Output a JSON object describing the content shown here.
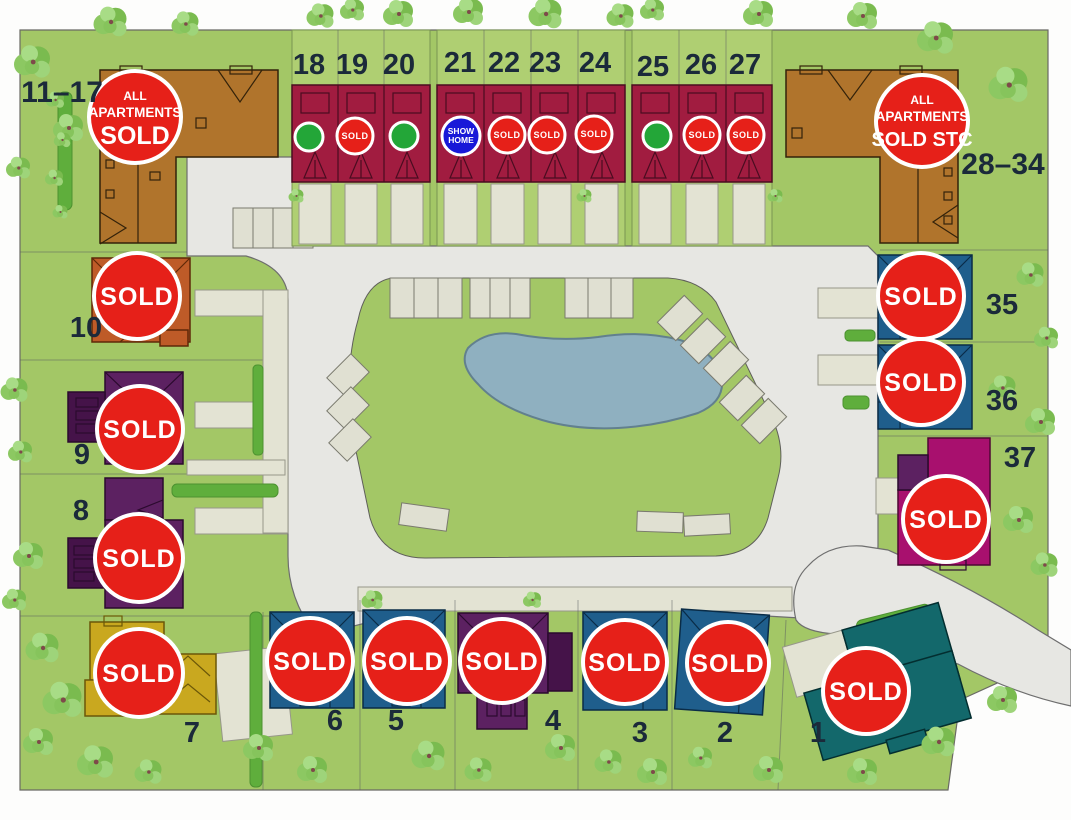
{
  "labels": {
    "sold": "SOLD"
  },
  "apartment_blocks": {
    "left": {
      "range": "11–17",
      "badge_lines": [
        "ALL",
        "APARTMENTS",
        "SOLD"
      ],
      "status": "All apartments sold"
    },
    "right": {
      "range": "28–34",
      "badge_lines": [
        "ALL",
        "APARTMENTS",
        "SOLD STC"
      ],
      "status": "All apartments sold STC"
    }
  },
  "show_home_badge": {
    "lines": [
      "SHOW",
      "HOME"
    ]
  },
  "plots": {
    "1": {
      "number": "1",
      "status": "Sold"
    },
    "2": {
      "number": "2",
      "status": "Sold"
    },
    "3": {
      "number": "3",
      "status": "Sold"
    },
    "4": {
      "number": "4",
      "status": "Sold"
    },
    "5": {
      "number": "5",
      "status": "Sold"
    },
    "6": {
      "number": "6",
      "status": "Sold"
    },
    "7": {
      "number": "7",
      "status": "Sold"
    },
    "8": {
      "number": "8",
      "status": "Sold"
    },
    "9": {
      "number": "9",
      "status": "Sold"
    },
    "10": {
      "number": "10",
      "status": "Sold"
    },
    "18": {
      "number": "18",
      "status": "Available"
    },
    "19": {
      "number": "19",
      "status": "Sold"
    },
    "20": {
      "number": "20",
      "status": "Available"
    },
    "21": {
      "number": "21",
      "status": "Show Home"
    },
    "22": {
      "number": "22",
      "status": "Sold"
    },
    "23": {
      "number": "23",
      "status": "Sold"
    },
    "24": {
      "number": "24",
      "status": "Sold"
    },
    "25": {
      "number": "25",
      "status": "Available"
    },
    "26": {
      "number": "26",
      "status": "Sold"
    },
    "27": {
      "number": "27",
      "status": "Sold"
    },
    "35": {
      "number": "35",
      "status": "Sold"
    },
    "36": {
      "number": "36",
      "status": "Sold"
    },
    "37": {
      "number": "37",
      "status": "Sold"
    }
  },
  "colors": {
    "sold_badge": "#E62019",
    "available_badge": "#23A638",
    "show_home_badge": "#1818D8",
    "site_green": "#A3C766",
    "road": "#E7E7E3",
    "pond": "#8FB0C0",
    "house_crimson": "#A11C40",
    "house_brown": "#B0742C",
    "house_orange": "#BE5B28",
    "house_purple": "#5C2161",
    "house_yellow": "#C9A81F",
    "house_navy": "#1F5E8C",
    "house_teal": "#13686B",
    "house_magenta": "#A8106E"
  }
}
